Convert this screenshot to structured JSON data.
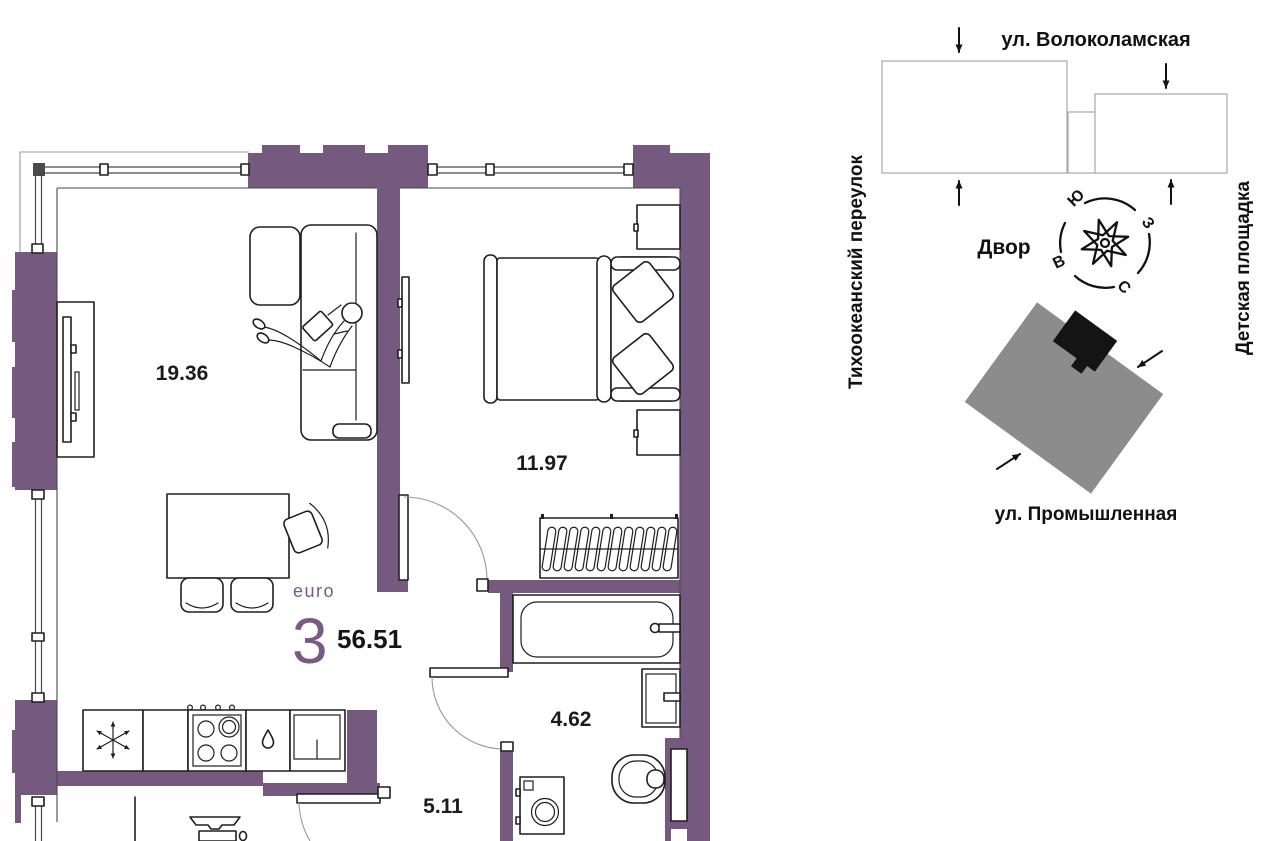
{
  "floorplan": {
    "format_label": "euro",
    "rooms_count": "3",
    "total_area": "56.51",
    "areas": {
      "living": "19.36",
      "bedroom": "11.97",
      "bathroom": "4.62",
      "hallway": "5.11"
    }
  },
  "site": {
    "street_top": "ул. Волоколамская",
    "street_left": "Тихоокеанский переулок",
    "street_bottom": "ул. Промышленная",
    "area_right": "Детская площадка",
    "courtyard": "Двор",
    "compass": {
      "south": "Ю",
      "west": "З",
      "east": "В",
      "north": "С"
    }
  },
  "colors": {
    "wall": "#76597E",
    "accent": "#7A5A85",
    "building": "#8C8C8C",
    "unit": "#141414",
    "line": "#1F1F1F"
  }
}
